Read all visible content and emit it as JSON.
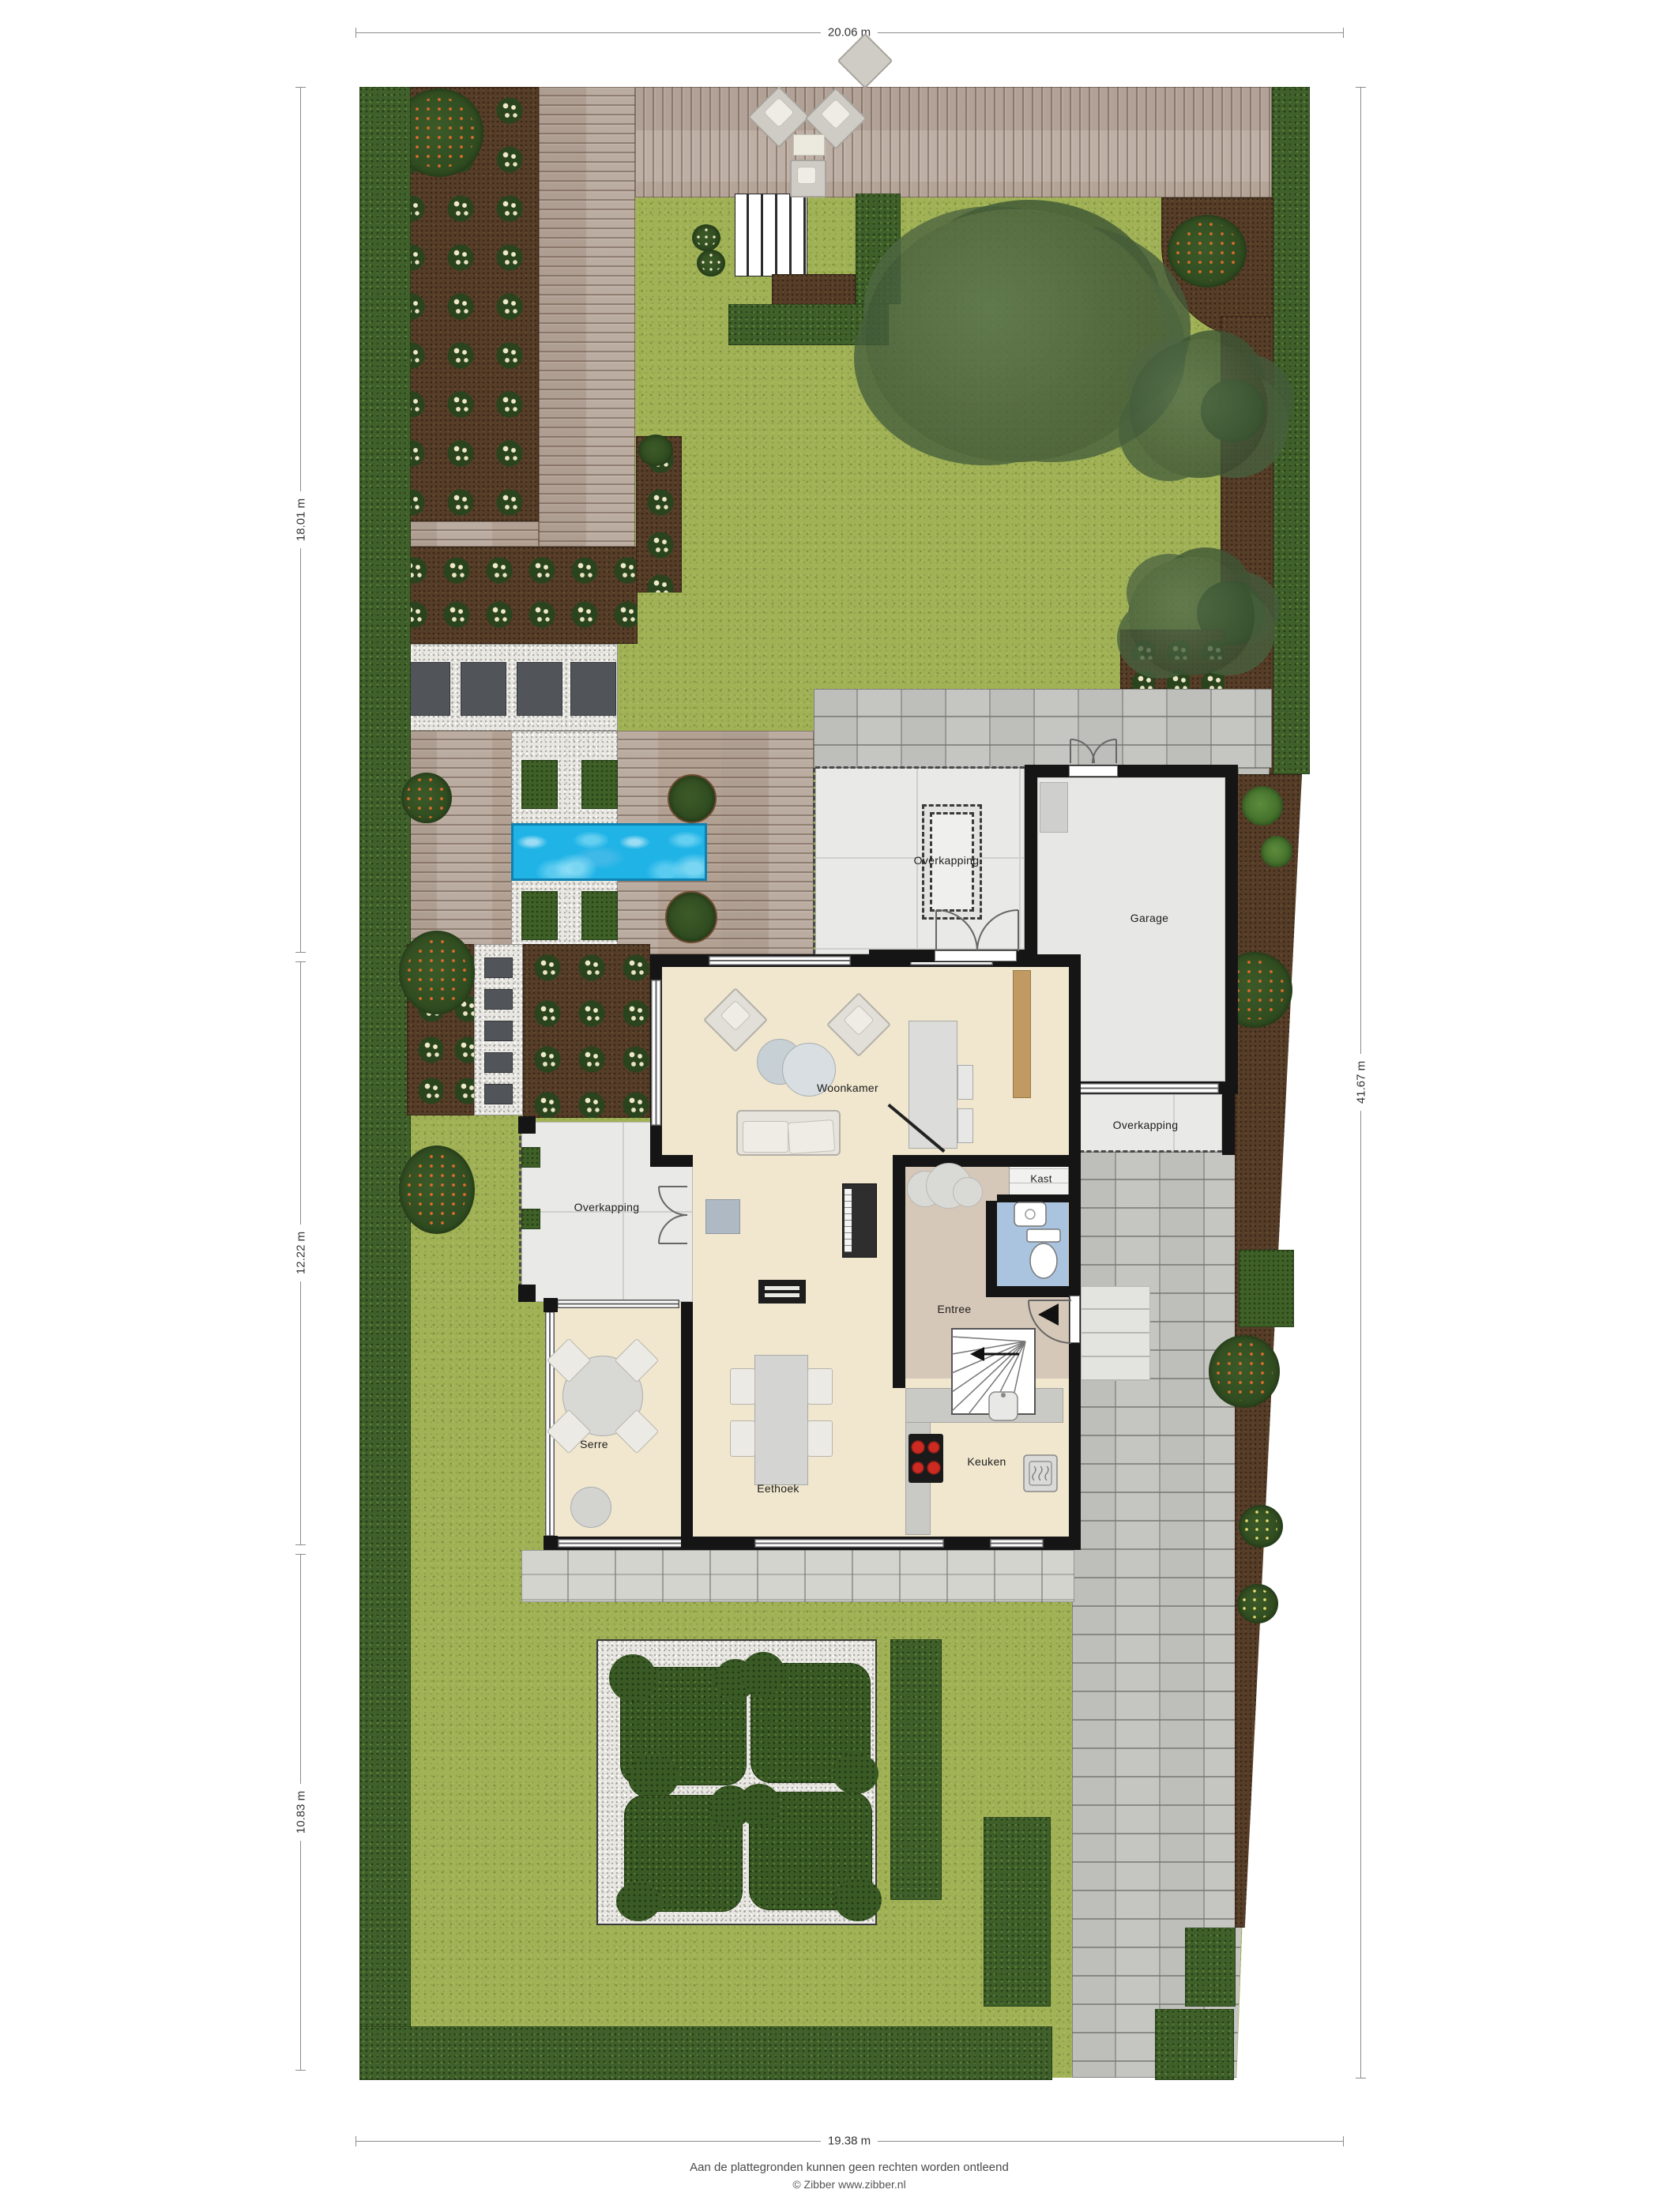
{
  "document": {
    "type": "residential site plan (situatie)",
    "footer_line1": "Aan de plattegronden kunnen geen rechten worden ontleend",
    "footer_line2": "© Zibber www.zibber.nl"
  },
  "dimensions": {
    "top": "20.06 m",
    "bottom": "19.38 m",
    "right": "41.67 m",
    "left_segments": [
      "18.01 m",
      "12.22 m",
      "10.83 m"
    ]
  },
  "rooms": {
    "carport": "Overkapping",
    "garage": "Garage",
    "overkapping_right": "Overkapping",
    "woonkamer": "Woonkamer",
    "kast": "Kast",
    "entree": "Entree",
    "overkapping_left": "Overkapping",
    "serre": "Serre",
    "eethoek": "Eethoek",
    "keuken": "Keuken"
  },
  "colors": {
    "lawn": "#a0b156",
    "hedge": "#40602b",
    "soil_bed": "#553d28",
    "deck": "#b6a69b",
    "gravel": "#e9e7e2",
    "pavers": "#c5c6c2",
    "pool_water": "#1fb3e6",
    "floor_living": "#f0e7ce",
    "floor_entree": "#d6c8b8",
    "floor_toilet": "#aac4e0",
    "wall": "#151515",
    "covered_area": "#e9e9e8"
  }
}
